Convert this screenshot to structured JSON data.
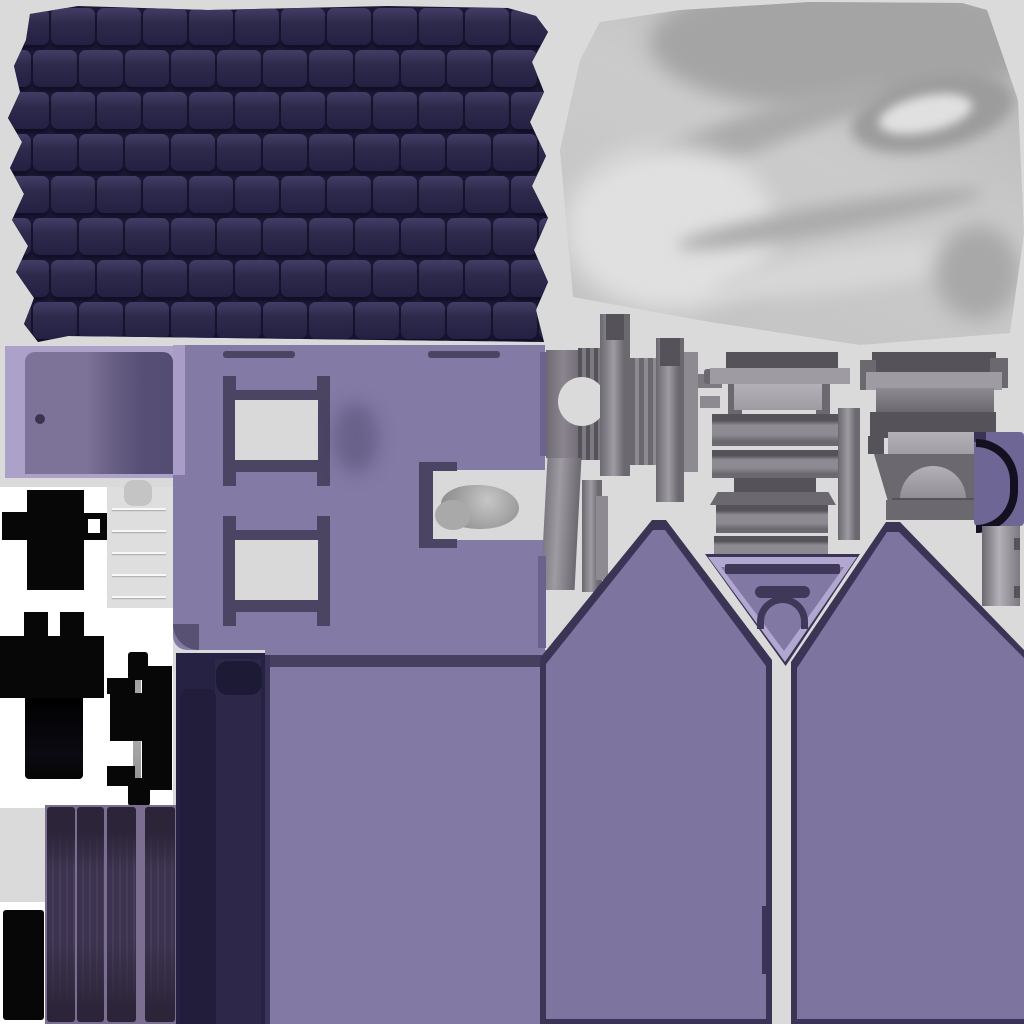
{
  "description": "UV texture atlas sheet for a low-poly 3D house model: roof shingles, satin curtain, purple walls with window cutouts, gray window-sill and frame parts, black metal fittings, hinge cylinder, plank door and gabled wall pieces",
  "palette": {
    "bg": "#dadada",
    "bg2": "#d9d9d9",
    "white": "#ffffff",
    "black": "#070707",
    "roof_tile": "#2e2a4c",
    "roof_tile_dark": "#242043",
    "roof_gap": "#1c1936",
    "roof_highlight": "#433d66",
    "fabric_dark": "#a4a4a4",
    "fabric_mid": "#b8b8b8",
    "fabric_light": "#e0e0e0",
    "lavender_frame": "#aca1c8",
    "door_slab": "#7d7298",
    "door_shadow": "#574f75",
    "door_knob": "#3a3450",
    "wall": "#837aa6",
    "wall_dark": "#4b4463",
    "wall_edge_lavender": "#a99dc7",
    "lower_wall": "#8279a5",
    "band_dark": "#46405e",
    "edge_dark": "#3a3456",
    "gable": "#7d74a0",
    "gable_outline": "#3b3455",
    "v_lavender": "#b2a7d0",
    "v_inner": "#8278a4",
    "v_dark": "#3f3859",
    "navy_panel": "#262243",
    "navy_panel_mid": "#2d2849",
    "navy_panel_dark": "#1d1a35",
    "plank": "#3c3350",
    "plank_dark": "#2c2539",
    "plank_grain": "#473d57",
    "plank_gap": "#7b6e91",
    "g_dark": "#55525a",
    "g_mid": "#6b6870",
    "g_base": "#7c7981",
    "g_light": "#8d8a92",
    "g_lighter": "#9e9ba3",
    "g_highlight": "#b3b0b8",
    "purple_strip": "#6a6390",
    "arc_purple": "#6e6694",
    "arc_black": "#14101f"
  },
  "roof": {
    "rows": 8,
    "cols": 13,
    "row_h": 42,
    "offset": 22
  },
  "door_planks": {
    "planks": [
      {
        "x": 2,
        "w": 28
      },
      {
        "x": 32,
        "w": 27
      },
      {
        "x": 62,
        "w": 29
      },
      {
        "x": 100,
        "w": 30
      }
    ]
  },
  "cylinder": {
    "seam_count": 6
  },
  "regions": {
    "roof": "dark navy shingle tile sheet, jagged edges",
    "fabric": "white-gray satin curtain with soft folds",
    "door_frame": "lavender frame with purple door slab and knob",
    "front_wall": "purple wall with two framed window openings and side notch with gray blob",
    "fittings": "black cross and bracket hardware on white background",
    "cylinder": "light gray hinge/paper roll cylinder with seams",
    "hinge": "black hinge assembly with gray post",
    "plank_door": "four dark wood planks on lavender backing",
    "navy_panel": "dark navy shutter panel",
    "lower_wall": "plain purple lower wall rectangle",
    "gables": "two peaked purple gable walls with dark outlines",
    "gable_vent": "inverted lavender triangle with arched vent",
    "sill_parts": "assorted gray window sill / frame profile pieces",
    "arc_piece": "purple block with black C-shaped arch"
  }
}
